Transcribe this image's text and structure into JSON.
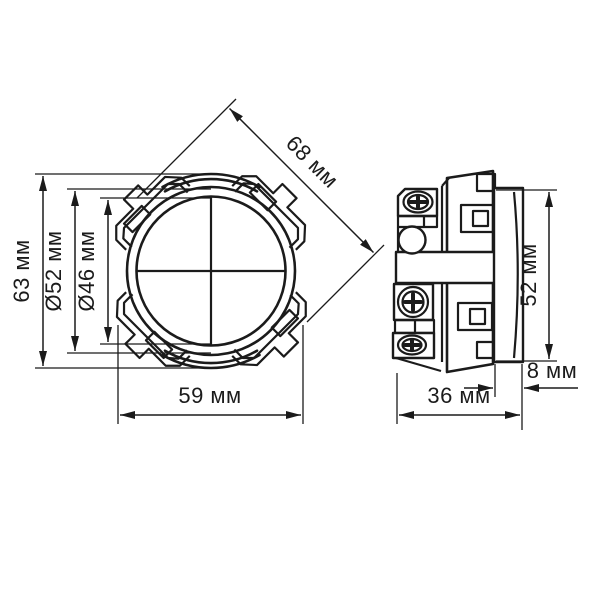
{
  "drawing": {
    "units": "мм",
    "colors": {
      "line": "#1b1b1b",
      "background": "#ffffff"
    },
    "front_view": {
      "height": {
        "label": "63 мм",
        "value": 63
      },
      "bezel_diameter": {
        "label": "Ø52 мм",
        "value": 52
      },
      "lens_diameter": {
        "label": "Ø46 мм",
        "value": 46
      },
      "width": {
        "label": "59 мм",
        "value": 59
      },
      "diagonal": {
        "label": "68 мм",
        "value": 68
      }
    },
    "side_view": {
      "height": {
        "label": "52 мм",
        "value": 52
      },
      "bezel_depth": {
        "label": "8 мм",
        "value": 8
      },
      "mounting_depth": {
        "label": "36 мм",
        "value": 36
      }
    }
  }
}
